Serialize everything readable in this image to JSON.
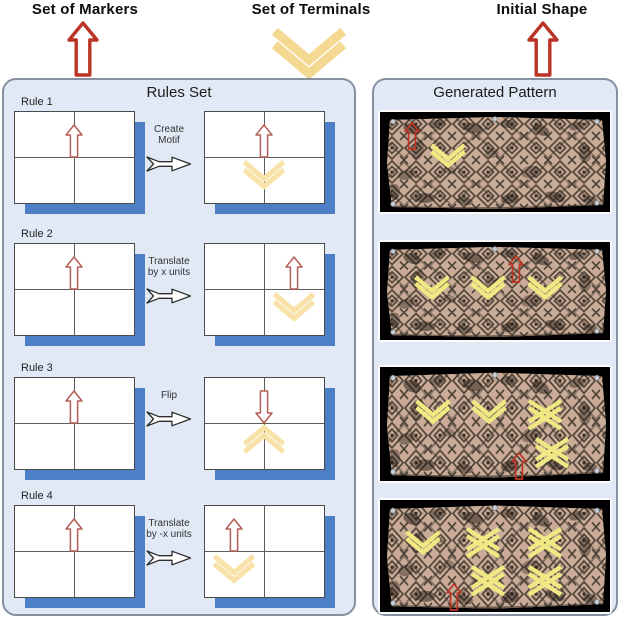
{
  "header": {
    "markers_label": "Set of Markers",
    "terminals_label": "Set of Terminals",
    "initial_shape_label": "Initial Shape"
  },
  "rules_panel": {
    "title": "Rules Set",
    "rules": [
      {
        "label": "Rule 1",
        "transform": [
          "Create",
          "Motif"
        ],
        "left": {
          "arrow": {
            "dir": "up",
            "pos": "center"
          }
        },
        "right": {
          "arrow": {
            "dir": "up",
            "pos": "center"
          },
          "chevron": {
            "dir": "down",
            "pos": "center"
          }
        }
      },
      {
        "label": "Rule 2",
        "transform": [
          "Translate",
          "by x units"
        ],
        "left": {
          "arrow": {
            "dir": "up",
            "pos": "center"
          }
        },
        "right": {
          "arrow": {
            "dir": "up",
            "pos": "right"
          },
          "chevron": {
            "dir": "down",
            "pos": "right"
          }
        }
      },
      {
        "label": "Rule 3",
        "transform": [
          "Flip"
        ],
        "left": {
          "arrow": {
            "dir": "up",
            "pos": "center"
          }
        },
        "right": {
          "arrow": {
            "dir": "down",
            "pos": "center"
          },
          "chevron": {
            "dir": "up",
            "pos": "center"
          }
        }
      },
      {
        "label": "Rule 4",
        "transform": [
          "Translate",
          "by -x units"
        ],
        "left": {
          "arrow": {
            "dir": "up",
            "pos": "center"
          }
        },
        "right": {
          "arrow": {
            "dir": "up",
            "pos": "left"
          },
          "chevron": {
            "dir": "down",
            "pos": "left"
          }
        }
      }
    ]
  },
  "pattern_panel": {
    "title": "Generated Pattern",
    "images": [
      {
        "height": 100,
        "markers": [
          {
            "type": "arrow",
            "x": 24,
            "y": 10
          },
          {
            "type": "chevron-down",
            "x": 46,
            "y": 30
          }
        ]
      },
      {
        "height": 98,
        "markers": [
          {
            "type": "chevron-down",
            "x": 30,
            "y": 32
          },
          {
            "type": "chevron-down",
            "x": 86,
            "y": 32
          },
          {
            "type": "chevron-down",
            "x": 143,
            "y": 32
          },
          {
            "type": "arrow",
            "x": 128,
            "y": 13
          }
        ]
      },
      {
        "height": 114,
        "markers": [
          {
            "type": "chevron-down",
            "x": 31,
            "y": 31
          },
          {
            "type": "chevron-down",
            "x": 87,
            "y": 31
          },
          {
            "type": "chevron-x",
            "x": 145,
            "y": 31
          },
          {
            "type": "chevron-x",
            "x": 152,
            "y": 69
          },
          {
            "type": "arrow",
            "x": 131,
            "y": 85
          }
        ]
      },
      {
        "height": 112,
        "markers": [
          {
            "type": "chevron-down",
            "x": 21,
            "y": 29
          },
          {
            "type": "chevron-x",
            "x": 83,
            "y": 26
          },
          {
            "type": "chevron-x",
            "x": 145,
            "y": 26
          },
          {
            "type": "chevron-x",
            "x": 88,
            "y": 64
          },
          {
            "type": "chevron-x",
            "x": 145,
            "y": 64
          },
          {
            "type": "arrow",
            "x": 66,
            "y": 83
          }
        ]
      }
    ]
  },
  "colors": {
    "marker_red": "#bb3425",
    "card_arrow_red": "#b55e55",
    "terminal_pale": "#f8e2aa",
    "terminal_header": "#f5d892",
    "bright_yellow": "#f0e883",
    "shadow_blue": "#4d7fc6",
    "cloth_tan": "#c9ab97",
    "panel_bg": "#e0e9f5"
  }
}
